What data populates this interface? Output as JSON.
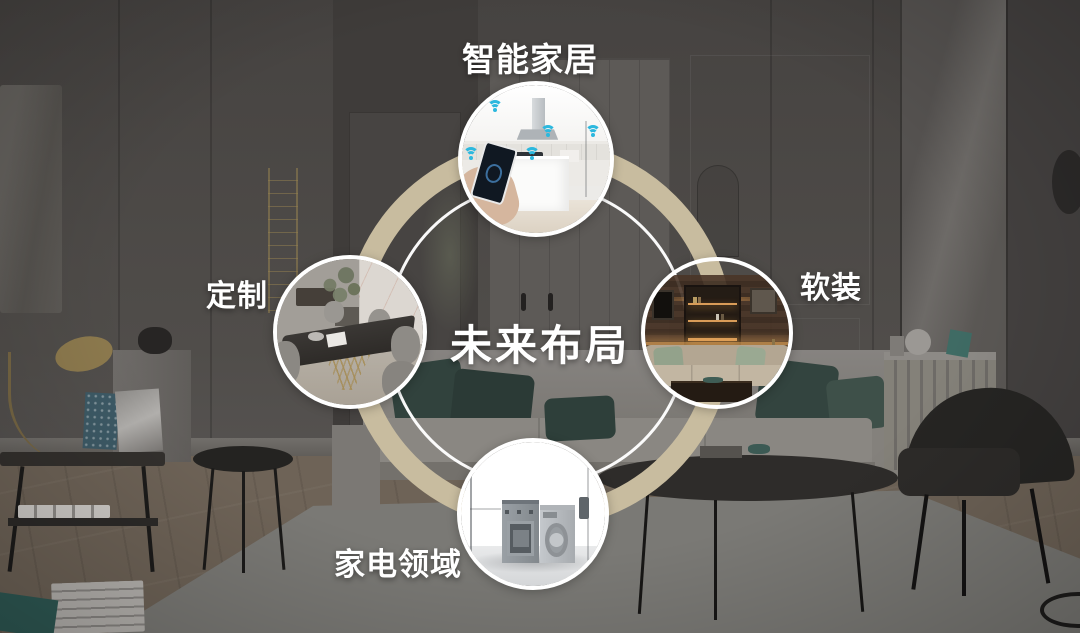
{
  "diagram": {
    "center_label": "未来布局",
    "nodes": [
      {
        "position": "top",
        "label": "智能家居",
        "photo": "smart-kitchen"
      },
      {
        "position": "right",
        "label": "软装",
        "photo": "living-room-soft-furnishing"
      },
      {
        "position": "bottom",
        "label": "家电领域",
        "photo": "home-appliances"
      },
      {
        "position": "left",
        "label": "定制",
        "photo": "custom-dining-furniture"
      }
    ],
    "colors": {
      "ring": "#c8bc9f",
      "inner_ring": "#ffffff",
      "label_text": "#ffffff",
      "wifi_icon": "#2cb8de"
    }
  }
}
